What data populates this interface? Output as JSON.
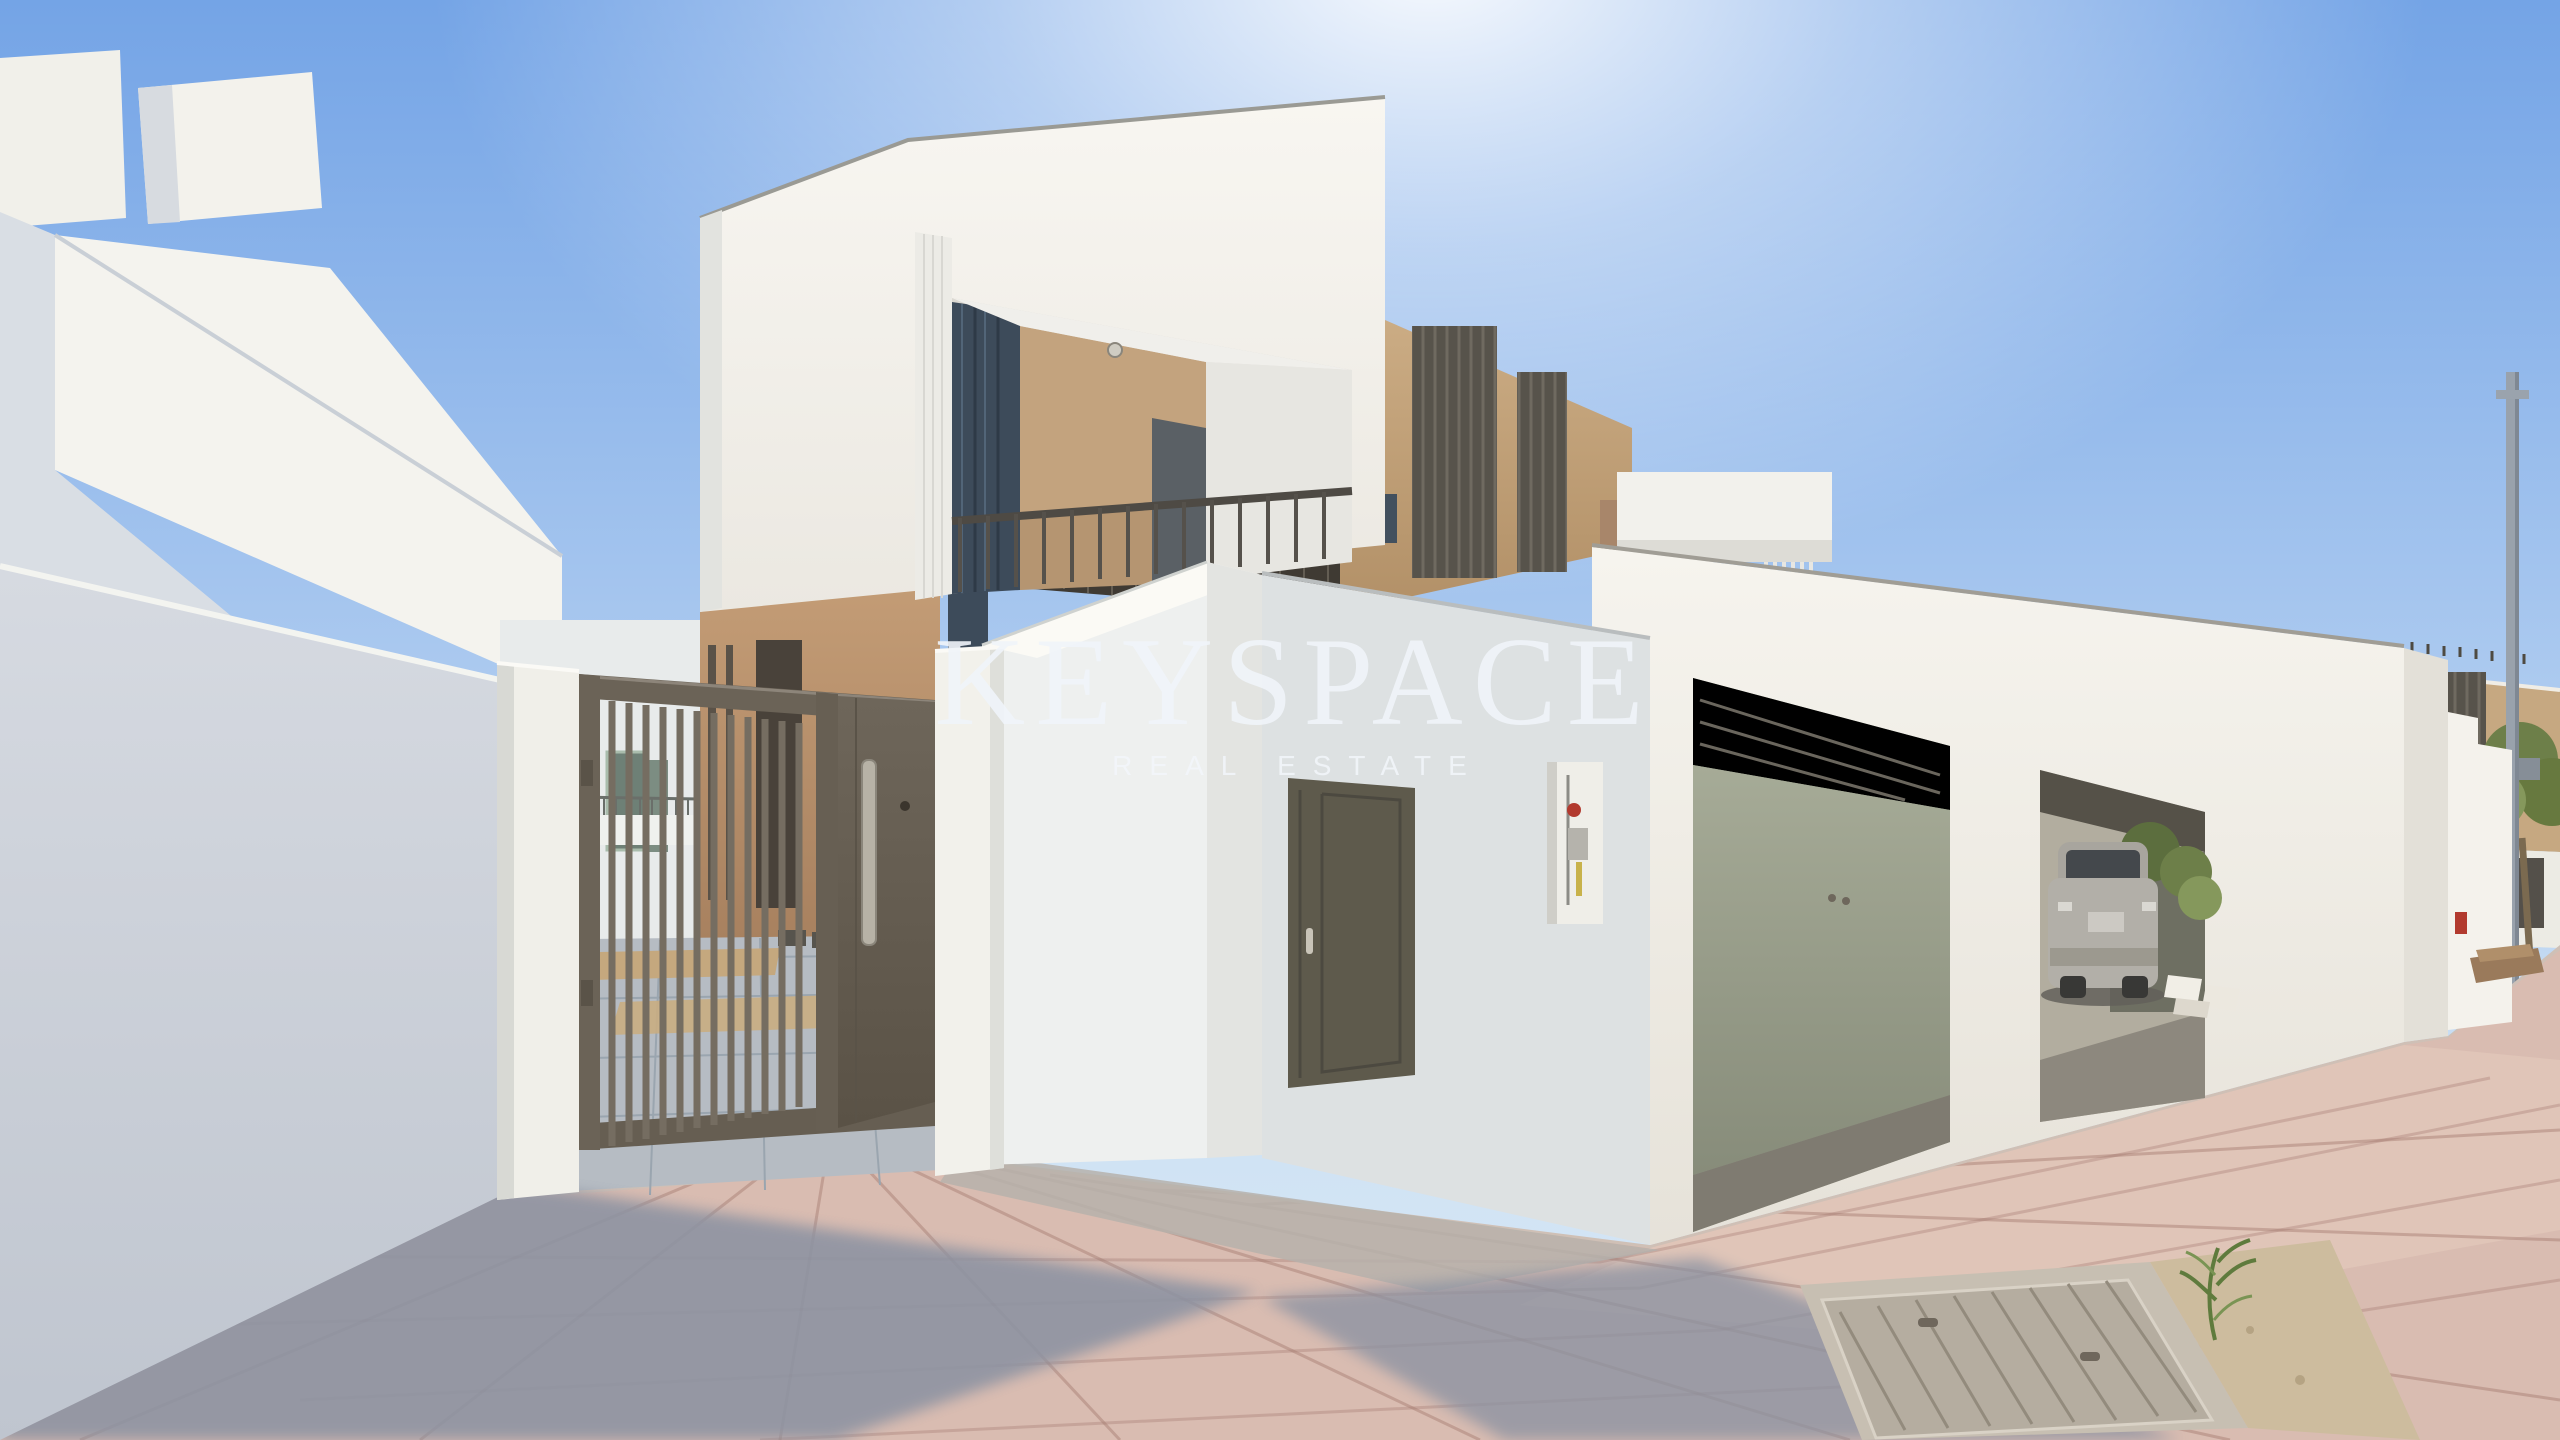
{
  "watermark": {
    "brand": "KEYSPACE",
    "tagline": "REAL ESTATE"
  },
  "palette": {
    "skyTop": "#74a4e6",
    "skyMid": "#a9c8ef",
    "skyLow": "#cfe2f4",
    "skyHaze": "#d9e9f6",
    "whiteLit": "#f5f3ee",
    "whiteBright": "#fbfaf5",
    "whiteShade": "#e6e6e1",
    "coolShade": "#d6dbe2",
    "tanLit": "#c6a881",
    "tanDark": "#a8866a",
    "louvre": "#57534b",
    "canopy": "#3f3a33",
    "gateMetal": "#6b6357",
    "gateDark": "#5f574c",
    "glass": "#3d4b5a",
    "doorOlive": "#5e5a4c",
    "garageBack": "#99a08c",
    "interiorWarm": "#b2ad9f",
    "carSilver": "#b2afa8",
    "green": "#6d7f49",
    "greenLight": "#85985c",
    "pavePink": "#d9bcb1",
    "paveShadow": "#8c93a2",
    "concrete": "#b6bcc3",
    "sand": "#cdbc9e",
    "poleGrey": "#99a2ac",
    "red": "#b23a2e"
  }
}
